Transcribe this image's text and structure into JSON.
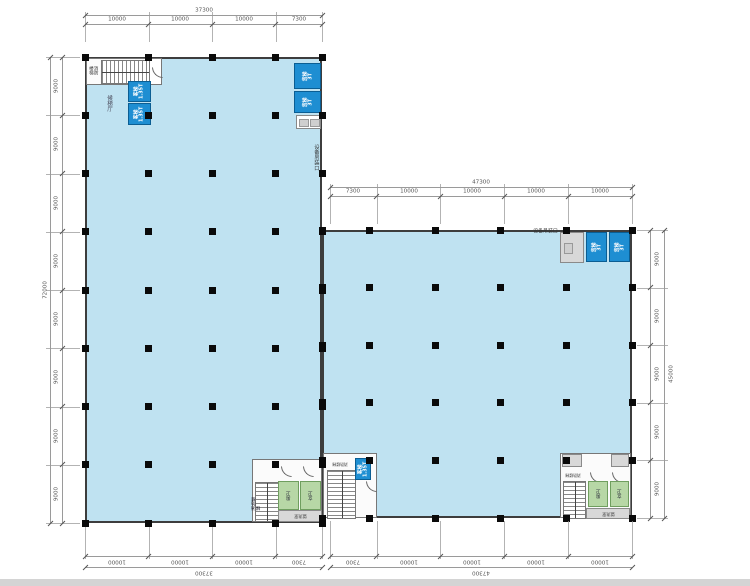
{
  "drawing": {
    "type": "architectural-floor-plan",
    "description": "L-shaped factory floor plan, two rectangular wings with column grid, stair cores, lifts and dimension chains"
  },
  "colors": {
    "floor_fill": "#bfe2f1",
    "wall": "#3d3d3d",
    "column": "#0a0a0a",
    "lift_fill": "#1e8ed2",
    "lift_border": "#0b5e93",
    "wc_fill": "#b7d7a6",
    "core_fill": "#d8d8d8",
    "dim_line": "#9a9a9a",
    "dim_text": "#555555",
    "window_edge": "#d4d4d4"
  },
  "labels": {
    "passenger_lift": "客梯\n1.35T",
    "freight_lift": "货梯\n3T",
    "fire_stair": "消防楼梯",
    "lift_lobby": "候梯厅",
    "equipment_hoist_opening": "设备吊装口",
    "male_toilet": "男卫",
    "female_toilet": "女卫",
    "washroom": "盥洗室"
  },
  "dimensions": {
    "top_left_building": {
      "total_label": "37300",
      "segment_labels": [
        "10000",
        "10000",
        "10000",
        "7300"
      ],
      "segments_mm": [
        10000,
        10000,
        10000,
        7300
      ]
    },
    "top_right_building": {
      "total_label": "47300",
      "segment_labels": [
        "7300",
        "10000",
        "10000",
        "10000",
        "10000"
      ],
      "segments_mm": [
        7300,
        10000,
        10000,
        10000,
        10000
      ]
    },
    "left_side": {
      "total_label": "72000",
      "segment_labels": [
        "9000",
        "9000",
        "9000",
        "9000",
        "9000",
        "9000",
        "9000",
        "9000"
      ],
      "segments_mm": [
        9000,
        9000,
        9000,
        9000,
        9000,
        9000,
        9000,
        9000
      ]
    },
    "right_side": {
      "total_label": "45000",
      "segment_labels": [
        "9000",
        "9000",
        "9000",
        "9000",
        "9000"
      ],
      "segments_mm": [
        9000,
        9000,
        9000,
        9000,
        9000
      ]
    },
    "bottom_left_building": {
      "total_label": "37300",
      "segment_labels": [
        "10000",
        "10000",
        "10000",
        "7300"
      ],
      "segments_mm": [
        10000,
        10000,
        10000,
        7300
      ]
    },
    "bottom_right_building": {
      "total_label": "47300",
      "segment_labels": [
        "7300",
        "10000",
        "10000",
        "10000",
        "10000"
      ],
      "segments_mm": [
        7300,
        10000,
        10000,
        10000,
        10000
      ]
    }
  },
  "structure": {
    "left_building": {
      "width_mm": 37300,
      "height_mm": 72000,
      "col_lines_mm": [
        0,
        10000,
        20000,
        30000,
        37300
      ],
      "row_lines_mm": [
        0,
        9000,
        18000,
        27000,
        36000,
        45000,
        54000,
        63000,
        72000
      ]
    },
    "right_building": {
      "width_mm": 47300,
      "height_mm": 45000,
      "col_lines_mm": [
        0,
        7300,
        17300,
        27300,
        37300,
        47300
      ],
      "row_lines_mm": [
        0,
        9000,
        18000,
        27000,
        36000,
        45000
      ]
    }
  }
}
